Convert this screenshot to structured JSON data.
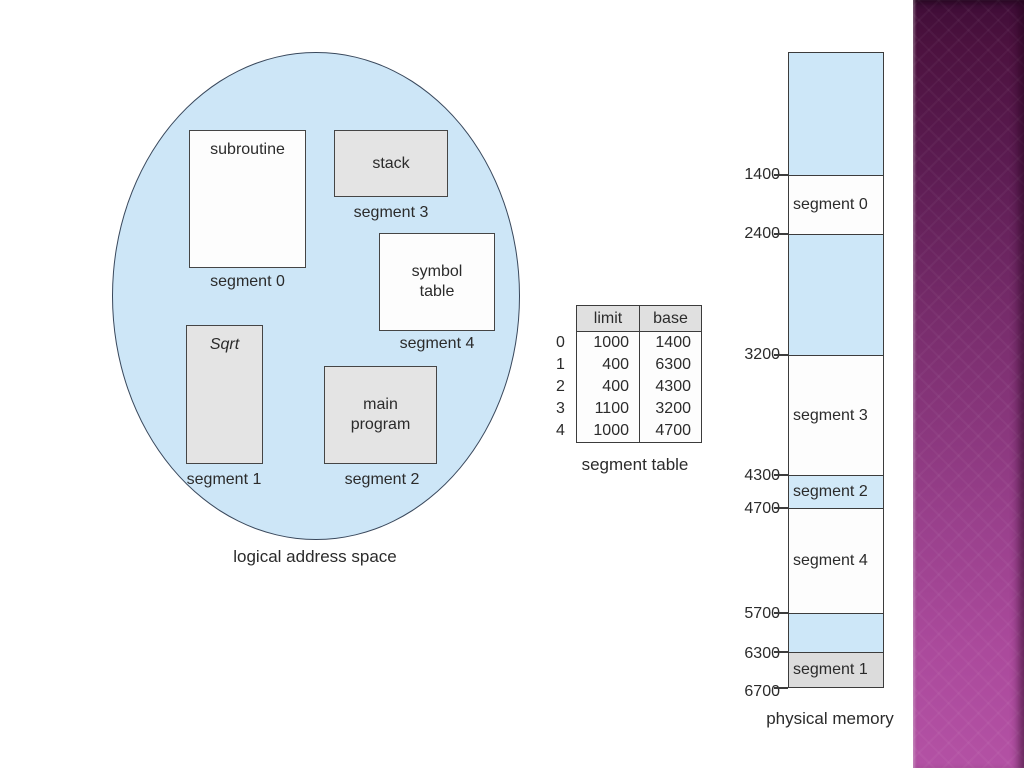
{
  "logical_address_space": {
    "caption": "logical address space",
    "fill_color": "#cde6f7",
    "boxes": [
      {
        "label": "subroutine",
        "caption": "segment 0",
        "fill": "white"
      },
      {
        "label": "stack",
        "caption": "segment 3",
        "fill": "gray"
      },
      {
        "label": "symbol table",
        "caption": "segment 4",
        "fill": "white"
      },
      {
        "label": "Sqrt",
        "caption": "segment 1",
        "fill": "gray"
      },
      {
        "label": "main program",
        "caption": "segment 2",
        "fill": "gray"
      }
    ]
  },
  "segment_table": {
    "caption": "segment table",
    "columns": [
      "limit",
      "base"
    ],
    "rows": [
      {
        "index": "0",
        "limit": "1000",
        "base": "1400"
      },
      {
        "index": "1",
        "limit": "400",
        "base": "6300"
      },
      {
        "index": "2",
        "limit": "400",
        "base": "4300"
      },
      {
        "index": "3",
        "limit": "1100",
        "base": "3200"
      },
      {
        "index": "4",
        "limit": "1000",
        "base": "4700"
      }
    ]
  },
  "physical_memory": {
    "caption": "physical memory",
    "addresses": [
      "1400",
      "2400",
      "3200",
      "4300",
      "4700",
      "5700",
      "6300",
      "6700"
    ],
    "blocks": [
      {
        "label": "",
        "type": "free"
      },
      {
        "label": "segment 0",
        "type": "segment"
      },
      {
        "label": "",
        "type": "free"
      },
      {
        "label": "segment 3",
        "type": "segment"
      },
      {
        "label": "segment 2",
        "type": "segment"
      },
      {
        "label": "segment 4",
        "type": "segment"
      },
      {
        "label": "",
        "type": "free"
      },
      {
        "label": "segment 1",
        "type": "segment"
      }
    ]
  },
  "colors": {
    "free_space_blue": "#cde7f8",
    "segment_white": "#fdfdfd",
    "segment_gray": "#e4e4e4",
    "table_header_gray": "#e0e0e0",
    "accent_purple_top": "#3f0d37",
    "accent_purple_bottom": "#b351a4",
    "border_dark": "#3c3c3c"
  }
}
